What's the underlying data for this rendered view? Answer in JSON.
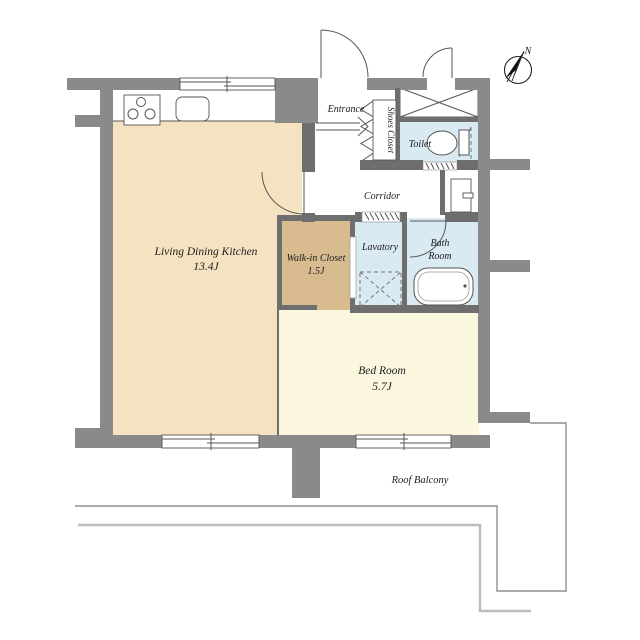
{
  "plan": {
    "compass": "N",
    "rooms": {
      "ldk": {
        "name": "Living Dining Kitchen",
        "size": "13.4J"
      },
      "walk_in_closet": {
        "name": "Walk-in Closet",
        "size": "1.5J"
      },
      "bedroom": {
        "name": "Bed Room",
        "size": "5.7J"
      },
      "entrance": {
        "name": "Entrance"
      },
      "shoes_closet": {
        "name": "Shoes Closet"
      },
      "toilet": {
        "name": "Toilet"
      },
      "corridor": {
        "name": "Corridor"
      },
      "lavatory": {
        "name": "Lavatory"
      },
      "bathroom": {
        "line1": "Bath",
        "line2": "Room"
      },
      "roof_balcony": {
        "name": "Roof Balcony"
      }
    },
    "colors": {
      "wall": "#8a8a8a",
      "interior_wall": "#6e6e6e",
      "ldk_floor": "#f5e2c0",
      "closet_floor": "#d8bc90",
      "bedroom_floor": "#fbf7df",
      "wet_area_floor": "#d9eaf2",
      "line": "#555555"
    }
  }
}
